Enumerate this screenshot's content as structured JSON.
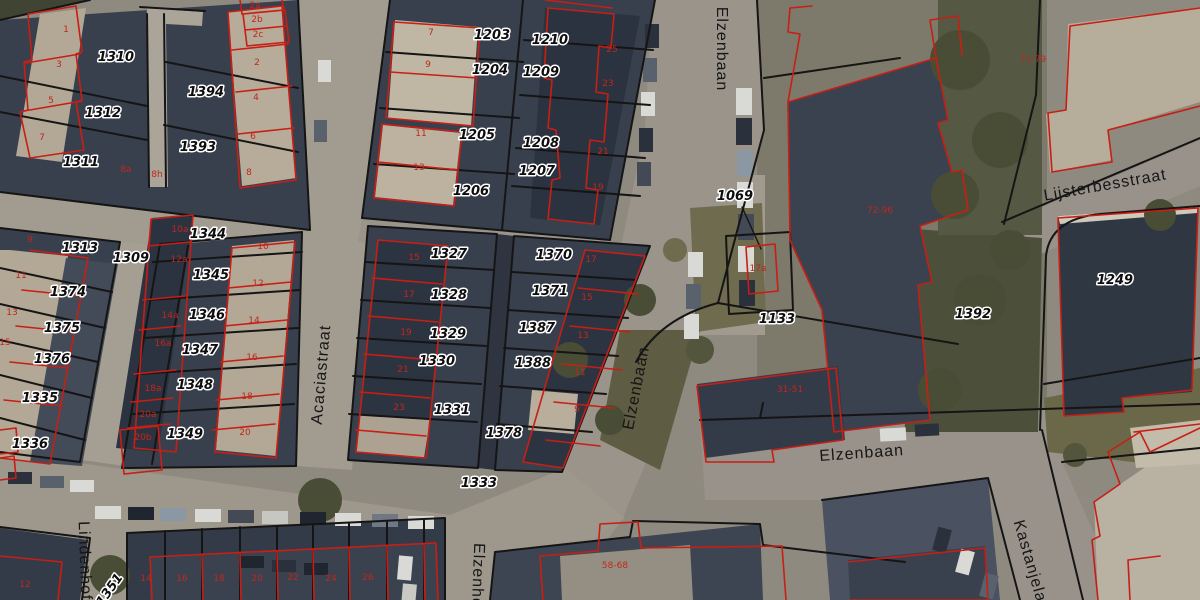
{
  "map": {
    "type": "cadastral-aerial-view",
    "colors": {
      "parcel_boundary": "#151515",
      "building_outline": "#c81e14",
      "parcel_label": "#0d0d0d",
      "parcel_label_halo": "#ffffff",
      "house_number": "#c2261b",
      "street_label": "#161616"
    },
    "street_labels": [
      {
        "text": "Elzenbaan",
        "x": 717,
        "y": 49,
        "rotate": 90,
        "size": 17
      },
      {
        "text": "Acaciastraat",
        "x": 326,
        "y": 375,
        "rotate": -85,
        "size": 16
      },
      {
        "text": "Elzenbaan",
        "x": 641,
        "y": 389,
        "rotate": -79,
        "size": 17
      },
      {
        "text": "Elzenbaan",
        "x": 862,
        "y": 458,
        "rotate": -4,
        "size": 16
      },
      {
        "text": "Lijsterbesstraat",
        "x": 1106,
        "y": 190,
        "rotate": -10,
        "size": 16
      },
      {
        "text": "Kastanjelaan",
        "x": 1028,
        "y": 572,
        "rotate": 74,
        "size": 15
      },
      {
        "text": "Lindenhof",
        "x": 80,
        "y": 561,
        "rotate": 88,
        "size": 15
      },
      {
        "text": "Elzenhof",
        "x": 473,
        "y": 578,
        "rotate": 92,
        "size": 15
      }
    ],
    "parcel_labels": [
      {
        "text": "1310",
        "x": 116,
        "y": 61
      },
      {
        "text": "1312",
        "x": 103,
        "y": 117
      },
      {
        "text": "1311",
        "x": 81,
        "y": 166
      },
      {
        "text": "1394",
        "x": 206,
        "y": 96
      },
      {
        "text": "1393",
        "x": 198,
        "y": 151
      },
      {
        "text": "1313",
        "x": 80,
        "y": 252
      },
      {
        "text": "1309",
        "x": 131,
        "y": 262
      },
      {
        "text": "1374",
        "x": 68,
        "y": 296
      },
      {
        "text": "1375",
        "x": 62,
        "y": 332
      },
      {
        "text": "1376",
        "x": 52,
        "y": 363
      },
      {
        "text": "1335",
        "x": 40,
        "y": 402
      },
      {
        "text": "1336",
        "x": 30,
        "y": 448
      },
      {
        "text": "1344",
        "x": 208,
        "y": 238
      },
      {
        "text": "1345",
        "x": 211,
        "y": 279
      },
      {
        "text": "1346",
        "x": 207,
        "y": 319
      },
      {
        "text": "1347",
        "x": 200,
        "y": 354
      },
      {
        "text": "1348",
        "x": 195,
        "y": 389
      },
      {
        "text": "1349",
        "x": 185,
        "y": 438
      },
      {
        "text": "1203",
        "x": 492,
        "y": 39
      },
      {
        "text": "1204",
        "x": 490,
        "y": 74
      },
      {
        "text": "1205",
        "x": 477,
        "y": 139
      },
      {
        "text": "1206",
        "x": 471,
        "y": 195
      },
      {
        "text": "1210",
        "x": 550,
        "y": 44
      },
      {
        "text": "1209",
        "x": 541,
        "y": 76
      },
      {
        "text": "1208",
        "x": 541,
        "y": 147
      },
      {
        "text": "1207",
        "x": 537,
        "y": 175
      },
      {
        "text": "1327",
        "x": 449,
        "y": 258
      },
      {
        "text": "1328",
        "x": 449,
        "y": 299
      },
      {
        "text": "1329",
        "x": 448,
        "y": 338
      },
      {
        "text": "1330",
        "x": 437,
        "y": 365
      },
      {
        "text": "1331",
        "x": 452,
        "y": 414
      },
      {
        "text": "1370",
        "x": 554,
        "y": 259
      },
      {
        "text": "1371",
        "x": 550,
        "y": 295
      },
      {
        "text": "1387",
        "x": 537,
        "y": 332
      },
      {
        "text": "1388",
        "x": 533,
        "y": 367
      },
      {
        "text": "1378",
        "x": 504,
        "y": 437
      },
      {
        "text": "1333",
        "x": 479,
        "y": 487
      },
      {
        "text": "1069",
        "x": 735,
        "y": 200
      },
      {
        "text": "1133",
        "x": 777,
        "y": 323
      },
      {
        "text": "1392",
        "x": 973,
        "y": 318
      },
      {
        "text": "1249",
        "x": 1115,
        "y": 284
      },
      {
        "text": "1351",
        "x": 113,
        "y": 592,
        "rotate": -55
      }
    ],
    "house_numbers": [
      {
        "text": "1",
        "x": 66,
        "y": 32
      },
      {
        "text": "3",
        "x": 59,
        "y": 67
      },
      {
        "text": "5",
        "x": 51,
        "y": 103
      },
      {
        "text": "7",
        "x": 42,
        "y": 140
      },
      {
        "text": "9",
        "x": 30,
        "y": 242
      },
      {
        "text": "11",
        "x": 21,
        "y": 278
      },
      {
        "text": "13",
        "x": 12,
        "y": 315
      },
      {
        "text": "15",
        "x": 5,
        "y": 345
      },
      {
        "text": "2a",
        "x": 255,
        "y": 8
      },
      {
        "text": "2b",
        "x": 257,
        "y": 22
      },
      {
        "text": "2c",
        "x": 258,
        "y": 37
      },
      {
        "text": "2",
        "x": 257,
        "y": 65
      },
      {
        "text": "4",
        "x": 256,
        "y": 100
      },
      {
        "text": "6",
        "x": 253,
        "y": 139
      },
      {
        "text": "8",
        "x": 249,
        "y": 175
      },
      {
        "text": "8a",
        "x": 126,
        "y": 172
      },
      {
        "text": "8h",
        "x": 157,
        "y": 177
      },
      {
        "text": "7",
        "x": 431,
        "y": 35
      },
      {
        "text": "9",
        "x": 428,
        "y": 67
      },
      {
        "text": "11",
        "x": 421,
        "y": 136
      },
      {
        "text": "13",
        "x": 419,
        "y": 170
      },
      {
        "text": "25",
        "x": 612,
        "y": 52
      },
      {
        "text": "23",
        "x": 608,
        "y": 86
      },
      {
        "text": "21",
        "x": 603,
        "y": 154
      },
      {
        "text": "19",
        "x": 598,
        "y": 190
      },
      {
        "text": "10a",
        "x": 180,
        "y": 232
      },
      {
        "text": "12a",
        "x": 179,
        "y": 262
      },
      {
        "text": "14a",
        "x": 170,
        "y": 318
      },
      {
        "text": "16a",
        "x": 163,
        "y": 346
      },
      {
        "text": "18a",
        "x": 153,
        "y": 391
      },
      {
        "text": "20a",
        "x": 148,
        "y": 417
      },
      {
        "text": "20b",
        "x": 143,
        "y": 440
      },
      {
        "text": "10",
        "x": 263,
        "y": 249
      },
      {
        "text": "12",
        "x": 258,
        "y": 286
      },
      {
        "text": "14",
        "x": 254,
        "y": 323
      },
      {
        "text": "16",
        "x": 252,
        "y": 360
      },
      {
        "text": "18",
        "x": 247,
        "y": 399
      },
      {
        "text": "20",
        "x": 245,
        "y": 435
      },
      {
        "text": "15",
        "x": 414,
        "y": 260
      },
      {
        "text": "17",
        "x": 409,
        "y": 297
      },
      {
        "text": "19",
        "x": 406,
        "y": 335
      },
      {
        "text": "21",
        "x": 403,
        "y": 372
      },
      {
        "text": "23",
        "x": 399,
        "y": 410
      },
      {
        "text": "17",
        "x": 591,
        "y": 262
      },
      {
        "text": "15",
        "x": 587,
        "y": 300
      },
      {
        "text": "13",
        "x": 583,
        "y": 338
      },
      {
        "text": "11",
        "x": 580,
        "y": 375
      },
      {
        "text": "9",
        "x": 577,
        "y": 412
      },
      {
        "text": "14",
        "x": 146,
        "y": 581
      },
      {
        "text": "16",
        "x": 182,
        "y": 581
      },
      {
        "text": "18",
        "x": 219,
        "y": 581
      },
      {
        "text": "20",
        "x": 257,
        "y": 581
      },
      {
        "text": "22",
        "x": 293,
        "y": 580
      },
      {
        "text": "24",
        "x": 331,
        "y": 581
      },
      {
        "text": "26",
        "x": 368,
        "y": 580
      },
      {
        "text": "12",
        "x": 25,
        "y": 587
      },
      {
        "text": "17a",
        "x": 758,
        "y": 271
      },
      {
        "text": "72-96",
        "x": 880,
        "y": 213
      },
      {
        "text": "71-79",
        "x": 1033,
        "y": 62
      },
      {
        "text": "31-51",
        "x": 790,
        "y": 392
      },
      {
        "text": "58-68",
        "x": 615,
        "y": 568
      }
    ]
  }
}
